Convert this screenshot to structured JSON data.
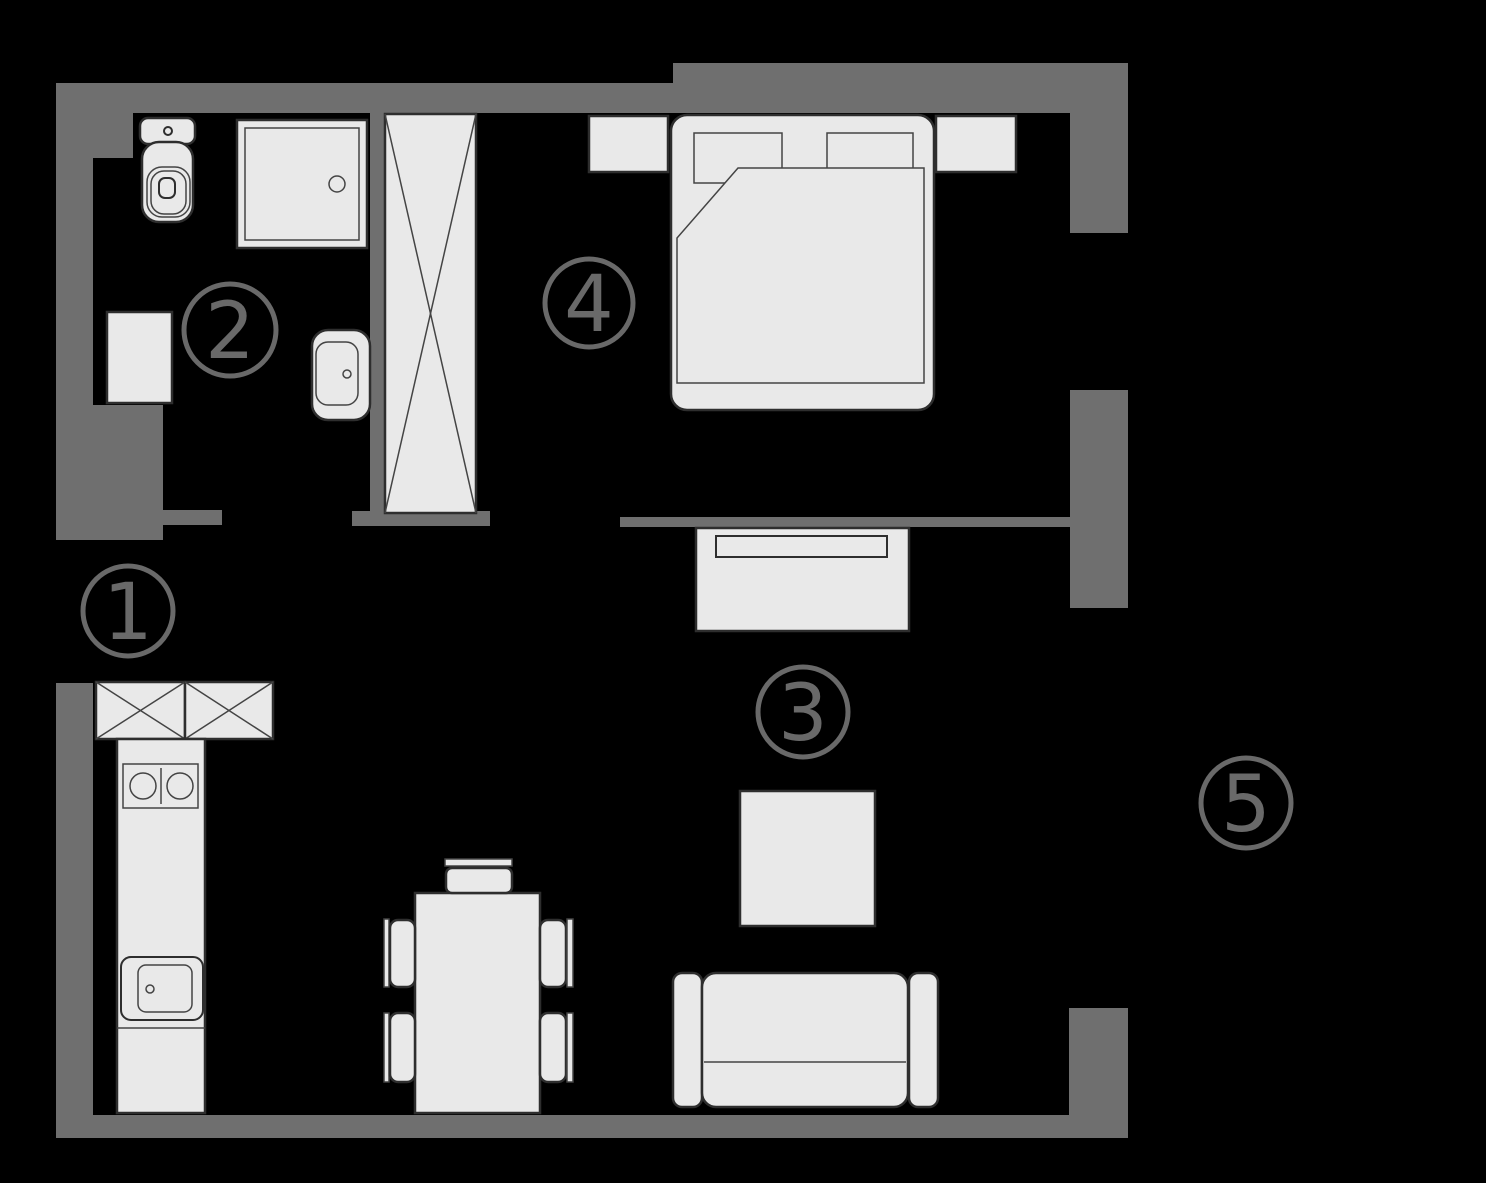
{
  "canvas": {
    "width": 1486,
    "height": 1183,
    "background": "#000000"
  },
  "palette": {
    "wall": "#6f6f6f",
    "furniture_fill": "#e9e9e9",
    "stroke_main": "#2e2e2e",
    "stroke_thin": "#444444",
    "label": "#696969",
    "main_width": 2.5,
    "thin_width": 1.5,
    "label_ring_width": 5,
    "label_font_size": 78
  },
  "rooms": [
    {
      "id": "hallway",
      "number": "1",
      "cx": 128,
      "cy": 611,
      "r": 45
    },
    {
      "id": "bathroom",
      "number": "2",
      "cx": 230,
      "cy": 330,
      "r": 46
    },
    {
      "id": "living-room",
      "number": "3",
      "cx": 803,
      "cy": 712,
      "r": 45
    },
    {
      "id": "bedroom",
      "number": "4",
      "cx": 589,
      "cy": 303,
      "r": 44
    },
    {
      "id": "balcony",
      "number": "5",
      "cx": 1246,
      "cy": 803,
      "r": 45
    }
  ],
  "walls": [
    {
      "name": "top-left",
      "x": 56,
      "y": 83,
      "w": 634,
      "h": 30
    },
    {
      "name": "top-right",
      "x": 673,
      "y": 63,
      "w": 455,
      "h": 50
    },
    {
      "name": "right-upper",
      "x": 1070,
      "y": 113,
      "w": 58,
      "h": 120
    },
    {
      "name": "right-middle",
      "x": 1070,
      "y": 390,
      "w": 58,
      "h": 218
    },
    {
      "name": "right-lower",
      "x": 1069,
      "y": 1008,
      "w": 59,
      "h": 130
    },
    {
      "name": "bottom",
      "x": 56,
      "y": 1115,
      "w": 1072,
      "h": 23
    },
    {
      "name": "left-upper",
      "x": 56,
      "y": 83,
      "w": 37,
      "h": 457
    },
    {
      "name": "left-corner-block",
      "x": 56,
      "y": 83,
      "w": 77,
      "h": 75
    },
    {
      "name": "left-niche-block",
      "x": 93,
      "y": 405,
      "w": 70,
      "h": 135
    },
    {
      "name": "bath-door-ledge",
      "x": 163,
      "y": 510,
      "w": 59,
      "h": 15
    },
    {
      "name": "left-lower",
      "x": 56,
      "y": 683,
      "w": 37,
      "h": 455
    },
    {
      "name": "bathroom-right",
      "x": 370,
      "y": 113,
      "w": 14,
      "h": 412
    },
    {
      "name": "bath-bottom",
      "x": 352,
      "y": 511,
      "w": 138,
      "h": 15
    },
    {
      "name": "bedroom-living-partition",
      "x": 620,
      "y": 517,
      "w": 450,
      "h": 10
    }
  ],
  "furniture": [
    {
      "name": "wardrobe",
      "type": "rect",
      "x": 385,
      "y": 114,
      "w": 91,
      "h": 399
    },
    {
      "name": "wardrobe-x-line-1",
      "type": "line",
      "x1": 385,
      "y1": 114,
      "x2": 476,
      "y2": 513,
      "stroke": "thin"
    },
    {
      "name": "wardrobe-x-line-2",
      "type": "line",
      "x1": 476,
      "y1": 114,
      "x2": 385,
      "y2": 513,
      "stroke": "thin"
    },
    {
      "name": "toilet-tank",
      "type": "rect",
      "x": 140,
      "y": 118,
      "w": 55,
      "h": 26,
      "rx": 8
    },
    {
      "name": "toilet-button",
      "type": "circle",
      "cx": 168,
      "cy": 131,
      "r": 4,
      "fill": "none",
      "sw": 2
    },
    {
      "name": "toilet-body",
      "type": "rect",
      "x": 142,
      "y": 142,
      "w": 51,
      "h": 80,
      "rx": 17
    },
    {
      "name": "toilet-bowl",
      "type": "rect",
      "x": 147,
      "y": 167,
      "w": 43,
      "h": 50,
      "rx": 15,
      "fill": "none",
      "stroke": "thin"
    },
    {
      "name": "toilet-bowl-inner",
      "type": "rect",
      "x": 151,
      "y": 171,
      "w": 35,
      "h": 43,
      "rx": 13,
      "fill": "none",
      "stroke": "thin"
    },
    {
      "name": "toilet-flush-center",
      "type": "rect",
      "x": 159,
      "y": 178,
      "w": 16,
      "h": 20,
      "rx": 6,
      "fill": "none",
      "sw": 2
    },
    {
      "name": "shower-tray",
      "type": "rect",
      "x": 237,
      "y": 120,
      "w": 130,
      "h": 128
    },
    {
      "name": "shower-tray-inner",
      "type": "rect",
      "x": 245,
      "y": 128,
      "w": 114,
      "h": 112,
      "fill": "none",
      "stroke": "thin"
    },
    {
      "name": "shower-drain",
      "type": "circle",
      "cx": 337,
      "cy": 184,
      "r": 8,
      "fill": "none",
      "stroke": "thin"
    },
    {
      "name": "washing-machine",
      "type": "rect",
      "x": 107,
      "y": 312,
      "w": 65,
      "h": 91
    },
    {
      "name": "bathroom-sink",
      "type": "rect",
      "x": 312,
      "y": 330,
      "w": 58,
      "h": 90,
      "rx": 16
    },
    {
      "name": "bathroom-sink-basin",
      "type": "rect",
      "x": 316,
      "y": 342,
      "w": 42,
      "h": 63,
      "rx": 12,
      "fill": "none",
      "stroke": "thin"
    },
    {
      "name": "bathroom-sink-faucet",
      "type": "circle",
      "cx": 347,
      "cy": 374,
      "r": 4,
      "fill": "none",
      "stroke": "thin"
    },
    {
      "name": "nightstand-left",
      "type": "rect",
      "x": 589,
      "y": 116,
      "w": 79,
      "h": 56
    },
    {
      "name": "nightstand-right",
      "type": "rect",
      "x": 936,
      "y": 116,
      "w": 80,
      "h": 56
    },
    {
      "name": "bed",
      "type": "rect",
      "x": 671,
      "y": 115,
      "w": 263,
      "h": 295,
      "rx": 16
    },
    {
      "name": "pillow-left",
      "type": "rect",
      "x": 694,
      "y": 133,
      "w": 88,
      "h": 50,
      "stroke": "thin"
    },
    {
      "name": "pillow-right",
      "type": "rect",
      "x": 827,
      "y": 133,
      "w": 86,
      "h": 50,
      "stroke": "thin"
    },
    {
      "name": "blanket",
      "type": "polygon",
      "points": "738,168 924,168 924,383 677,383 677,238",
      "stroke": "thin"
    },
    {
      "name": "tv-stand",
      "type": "rect",
      "x": 696,
      "y": 528,
      "w": 213,
      "h": 103
    },
    {
      "name": "tv",
      "type": "rect",
      "x": 716,
      "y": 536,
      "w": 171,
      "h": 21,
      "sw": 2
    },
    {
      "name": "coffee-table",
      "type": "rect",
      "x": 740,
      "y": 791,
      "w": 135,
      "h": 135
    },
    {
      "name": "sofa-armrest-left",
      "type": "rect",
      "x": 673,
      "y": 973,
      "w": 29,
      "h": 134,
      "rx": 9
    },
    {
      "name": "sofa-body",
      "type": "rect",
      "x": 702,
      "y": 973,
      "w": 206,
      "h": 134,
      "rx": 14
    },
    {
      "name": "sofa-seat-line",
      "type": "line",
      "x1": 704,
      "y1": 1062,
      "x2": 906,
      "y2": 1062,
      "stroke": "thin"
    },
    {
      "name": "sofa-armrest-right",
      "type": "rect",
      "x": 909,
      "y": 973,
      "w": 29,
      "h": 134,
      "rx": 9
    },
    {
      "name": "kitchen-cabinet-left",
      "type": "rect",
      "x": 96,
      "y": 682,
      "w": 89,
      "h": 57
    },
    {
      "name": "kitchen-cabinet-left-x1",
      "type": "line",
      "x1": 96,
      "y1": 682,
      "x2": 185,
      "y2": 739,
      "stroke": "thin"
    },
    {
      "name": "kitchen-cabinet-left-x2",
      "type": "line",
      "x1": 185,
      "y1": 682,
      "x2": 96,
      "y2": 739,
      "stroke": "thin"
    },
    {
      "name": "kitchen-cabinet-right",
      "type": "rect",
      "x": 185,
      "y": 682,
      "w": 88,
      "h": 57
    },
    {
      "name": "kitchen-cabinet-right-x1",
      "type": "line",
      "x1": 185,
      "y1": 682,
      "x2": 273,
      "y2": 739,
      "stroke": "thin"
    },
    {
      "name": "kitchen-cabinet-right-x2",
      "type": "line",
      "x1": 273,
      "y1": 682,
      "x2": 185,
      "y2": 739,
      "stroke": "thin"
    },
    {
      "name": "kitchen-counter",
      "type": "rect",
      "x": 117,
      "y": 739,
      "w": 88,
      "h": 374
    },
    {
      "name": "stove",
      "type": "rect",
      "x": 123,
      "y": 764,
      "w": 75,
      "h": 44,
      "fill": "none",
      "stroke": "thin"
    },
    {
      "name": "stove-burner-left",
      "type": "circle",
      "cx": 143,
      "cy": 786,
      "r": 13,
      "fill": "none",
      "stroke": "thin"
    },
    {
      "name": "stove-burner-right",
      "type": "circle",
      "cx": 180,
      "cy": 786,
      "r": 13,
      "fill": "none",
      "stroke": "thin"
    },
    {
      "name": "stove-divider",
      "type": "line",
      "x1": 161,
      "y1": 768,
      "x2": 161,
      "y2": 804,
      "stroke": "thin"
    },
    {
      "name": "kitchen-sink",
      "type": "rect",
      "x": 121,
      "y": 957,
      "w": 82,
      "h": 63,
      "rx": 10,
      "fill": "none",
      "sw": 2
    },
    {
      "name": "kitchen-sink-basin",
      "type": "rect",
      "x": 138,
      "y": 965,
      "w": 54,
      "h": 47,
      "rx": 8,
      "fill": "none",
      "stroke": "thin"
    },
    {
      "name": "kitchen-sink-faucet",
      "type": "circle",
      "cx": 150,
      "cy": 989,
      "r": 4,
      "fill": "none",
      "stroke": "thin"
    },
    {
      "name": "counter-divider",
      "type": "line",
      "x1": 117,
      "y1": 1028,
      "x2": 205,
      "y2": 1028,
      "stroke": "thin"
    },
    {
      "name": "dining-table",
      "type": "rect",
      "x": 415,
      "y": 893,
      "w": 125,
      "h": 220
    },
    {
      "name": "dining-chair-top-back",
      "type": "rect",
      "x": 445,
      "y": 859,
      "w": 67,
      "h": 7,
      "stroke": "thin"
    },
    {
      "name": "dining-chair-top-seat",
      "type": "rect",
      "x": 446,
      "y": 868,
      "w": 66,
      "h": 25,
      "rx": 6
    },
    {
      "name": "dining-chair-left1-back",
      "type": "rect",
      "x": 384,
      "y": 919,
      "w": 5,
      "h": 68,
      "stroke": "thin"
    },
    {
      "name": "dining-chair-left1-seat",
      "type": "rect",
      "x": 390,
      "y": 920,
      "w": 25,
      "h": 67,
      "rx": 8
    },
    {
      "name": "dining-chair-left2-back",
      "type": "rect",
      "x": 384,
      "y": 1013,
      "w": 5,
      "h": 69,
      "stroke": "thin"
    },
    {
      "name": "dining-chair-left2-seat",
      "type": "rect",
      "x": 390,
      "y": 1013,
      "w": 25,
      "h": 69,
      "rx": 8
    },
    {
      "name": "dining-chair-right1-seat",
      "type": "rect",
      "x": 540,
      "y": 920,
      "w": 26,
      "h": 67,
      "rx": 8
    },
    {
      "name": "dining-chair-right1-back",
      "type": "rect",
      "x": 567,
      "y": 919,
      "w": 6,
      "h": 68,
      "stroke": "thin"
    },
    {
      "name": "dining-chair-right2-seat",
      "type": "rect",
      "x": 540,
      "y": 1013,
      "w": 26,
      "h": 69,
      "rx": 8
    },
    {
      "name": "dining-chair-right2-back",
      "type": "rect",
      "x": 567,
      "y": 1013,
      "w": 6,
      "h": 69,
      "stroke": "thin"
    }
  ]
}
